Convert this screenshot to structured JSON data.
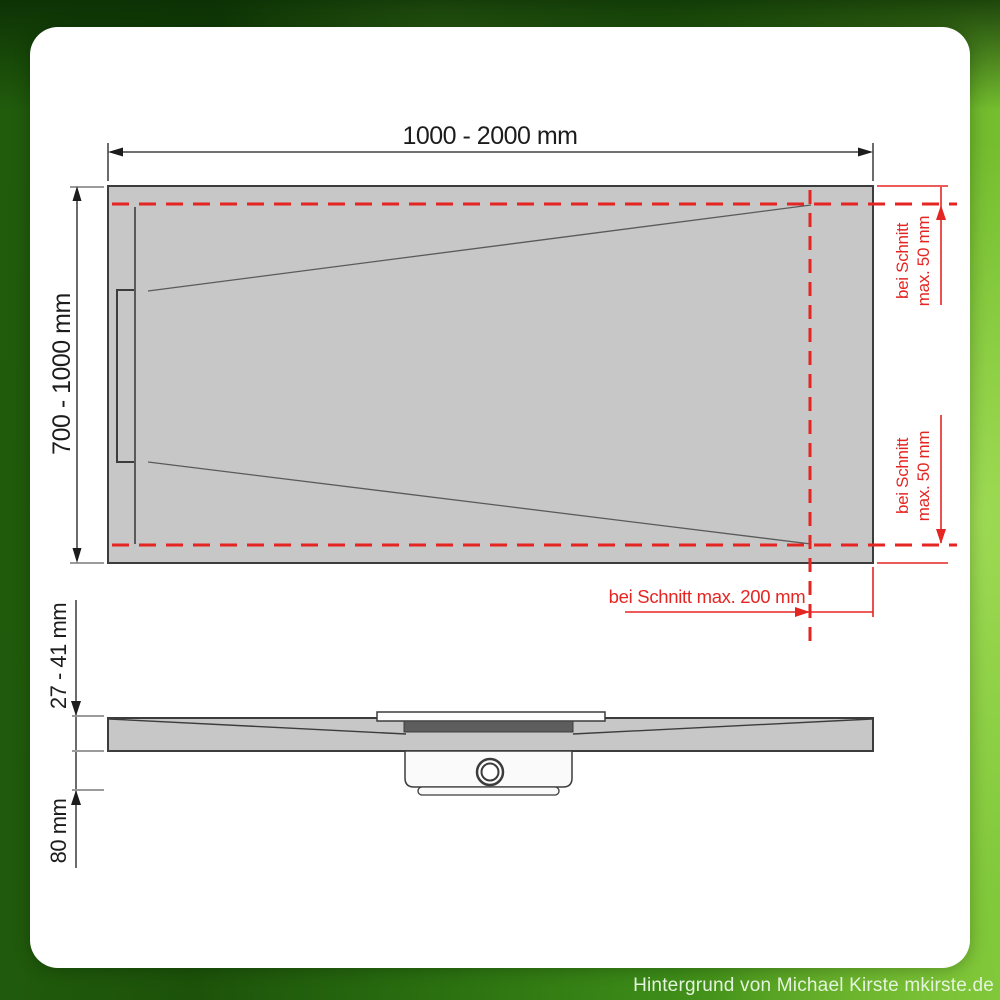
{
  "colors": {
    "accent_red": "#e42522",
    "tray_gray": "#c7c7c7",
    "outline": "#3c3c3c"
  },
  "labels": {
    "width_dim": "1000 - 2000 mm",
    "depth_dim": "700 - 1000 mm",
    "thickness_dim": "27 - 41 mm",
    "drain_height_dim": "80 mm",
    "cut_bottom_dim": "bei Schnitt max. 200 mm",
    "cut_right_top": {
      "line1": "bei Schnitt",
      "line2": "max. 50 mm"
    },
    "cut_right_bottom": {
      "line1": "bei Schnitt",
      "line2": "max. 50 mm"
    }
  },
  "watermark": "Hintergrund von Michael Kirste mkirste.de"
}
